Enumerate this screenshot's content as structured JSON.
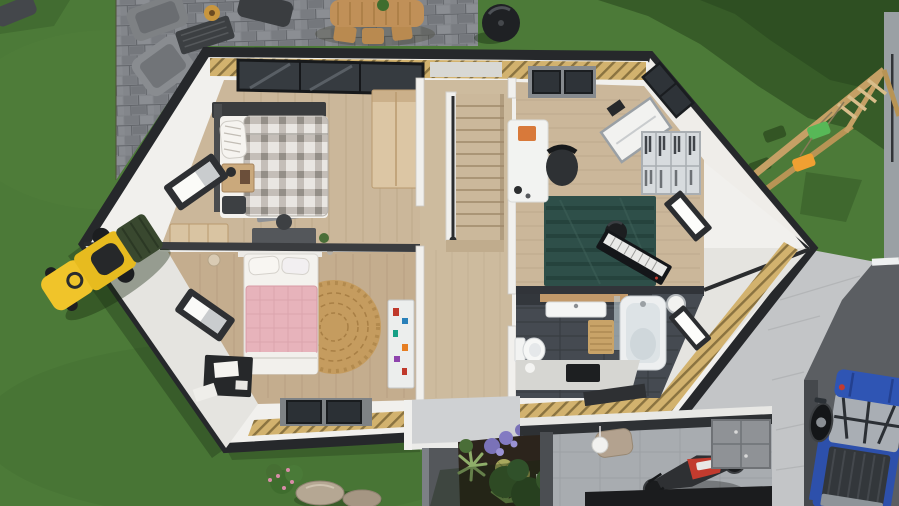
{
  "scene": {
    "kind": "3d-floorplan-cutaway-render",
    "view": "top-down"
  },
  "colors": {
    "grass": "#4c7a38",
    "grassLight": "#578540",
    "grassShadow": "#16280e",
    "paver": "#83868b",
    "paverDark": "#6d7075",
    "pathGray": "#9aa0a4",
    "drivewayDark": "#5b5e62",
    "exteriorWall": "#c3c5c7",
    "houseEdge": "#26282b",
    "roofCutYellow": "#d2b26e",
    "hatchLine": "#8a7340",
    "wallWhite": "#f1f0ed",
    "gableShade": "#e5e4e0",
    "floorWood": "#cbb79a",
    "floorWoodDark": "#c4ad8e",
    "stairWood": "#cdbb9e",
    "bathTile": "#454a51",
    "bathWallDark": "#33373c",
    "garageFloor": "#a8acb0",
    "rugGray": "#8e9196",
    "rugRound": "#c59c5f",
    "rugTeal": "#2e4f49",
    "bedPlaidBase": "#e9e6e2",
    "bedPink": "#e7b3bb",
    "linenWhite": "#f4f2ee",
    "woodFurniture": "#dcc6a4",
    "deskWhite": "#f2f3f1",
    "blackFurniture": "#26282a",
    "mowerYellow": "#e7bb1f",
    "truckBlue": "#2f55b4",
    "swingGreen": "#57b857",
    "swingOrange": "#f0a032",
    "swingWood": "#c5a065",
    "patioWood": "#c09058",
    "grillBlack": "#1f2124",
    "soil": "#2c241c",
    "plantGreen": "#4a6e38",
    "flowerPurple": "#7a72b8",
    "motoRed": "#c23b2e",
    "canopyGray": "#cfd1d3",
    "pillarGray": "#54575b"
  },
  "inventory": {
    "yard": [
      "lawn",
      "paver-patio",
      "gravel-path",
      "driveway",
      "tree-shadows",
      "rocks",
      "flowering-shrub",
      "tree-canopy"
    ],
    "outdoor": [
      "outdoor-dining-table",
      "dining-chairs",
      "lounge-chairs",
      "coffee-table",
      "serving-tray",
      "bbq-grill",
      "swing-set",
      "green-swing",
      "orange-swing",
      "ride-on-mower",
      "garden-bed",
      "agave",
      "barrel-cacti",
      "purple-flowers",
      "yucca"
    ],
    "rooms": [
      {
        "name": "bedroom-plaid",
        "items": [
          "plaid-bed",
          "pillows",
          "nightstand",
          "gray-rug",
          "desk",
          "cabinet",
          "wardrobe",
          "wall-window",
          "picture-window"
        ]
      },
      {
        "name": "bedroom-pink",
        "items": [
          "pink-bed",
          "pillows",
          "round-jute-rug",
          "sticker-wardrobe",
          "black-dresser",
          "papers",
          "skylights",
          "wall-window",
          "pendant-lamp"
        ]
      },
      {
        "name": "hallway",
        "items": [
          "staircase",
          "handrail",
          "landing-window"
        ]
      },
      {
        "name": "office-music-room",
        "items": [
          "white-desk",
          "orange-box",
          "office-chair",
          "drawing-board",
          "shelving-unit",
          "teal-rug",
          "stool",
          "keyboard-piano",
          "glow-window",
          "roof-windows"
        ]
      },
      {
        "name": "bathroom",
        "items": [
          "vanity-shelf",
          "floating-sink",
          "bathtub",
          "glass-screen",
          "toilet",
          "wood-bath-mat",
          "wall-light",
          "mirror-window",
          "counter",
          "dark-inset"
        ]
      },
      {
        "name": "garage",
        "items": [
          "motorcycle",
          "wall-cabinets",
          "pendant-lamp",
          "armchair",
          "floor-mat"
        ]
      }
    ],
    "vehicles": [
      "blue-pickup-truck",
      "motorcycle",
      "ride-on-mower"
    ]
  }
}
